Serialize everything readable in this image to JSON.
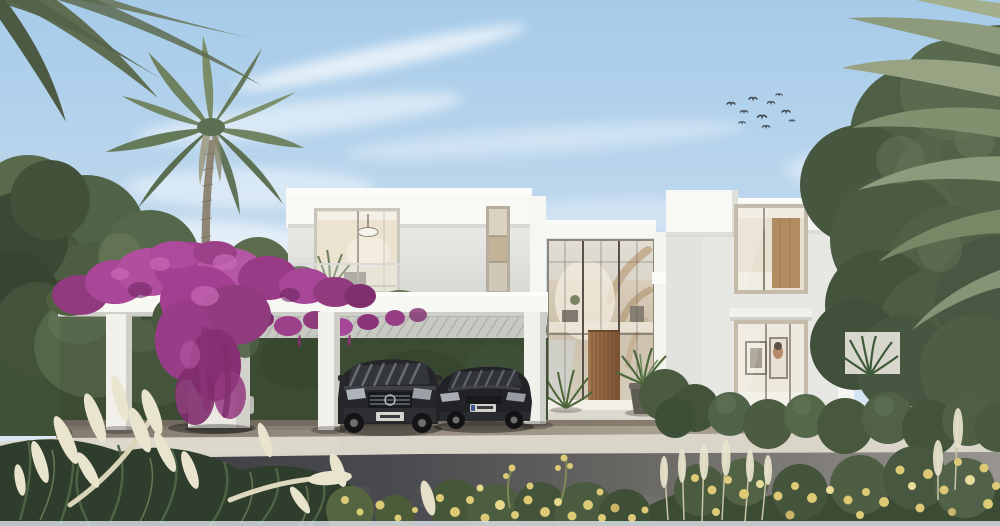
{
  "scene": {
    "type": "architectural-exterior-rendering",
    "description": "Photorealistic rendering of a modern two-storey white luxury villa with a double-height glass entrance atrium and wooden pivot door, a white pergola carport draped in magenta bougainvillea sheltering a dark SUV, a dark sedan and a white golf cart, flanked by palm trees, clipped hedges, a leafy tree, ornamental grasses and yellow flowers along a paved driveway under a clear blue sky with a small flock of birds",
    "time_of_day": "day",
    "weather": "sunny",
    "objects": [
      "sky",
      "clouds",
      "bird-flock",
      "left-palm-tree",
      "corner-palm-fronds",
      "right-palm-fronds",
      "background-trees",
      "right-tree",
      "villa-left-wing",
      "entrance-atrium",
      "wood-pivot-door",
      "villa-right-wing",
      "pergola-carport",
      "bougainvillea",
      "hedge",
      "golf-cart",
      "suv",
      "sedan",
      "planter-column",
      "entry-potted-plants",
      "entrance-steps",
      "driveway",
      "curb",
      "road",
      "ornamental-grass-plumes",
      "yellow-flowers",
      "shrubs",
      "neighbor-structures"
    ]
  },
  "counts": {
    "birds": 10,
    "cars": 2,
    "pergola_posts": 3,
    "storeys": 2
  },
  "colors": {
    "sky_top": "#a6cbe9",
    "sky_horizon": "#e6eff5",
    "cloud_white": "#ffffff",
    "bird_dark": "#41464d",
    "villa_white": "#f8f8f4",
    "villa_wall": "#e7e8e4",
    "villa_shadow_wall": "#b3afa6",
    "glass_warm": "#e4d9c7",
    "glass_cool": "#cfdade",
    "door_wood": "#a3764f",
    "accent_wood": "#b39872",
    "bougainvillea": "#a84697",
    "bougainvillea_dark": "#7f2e6e",
    "bougainvillea_light": "#c969b6",
    "palm_green": "#7a8c68",
    "palm_sage": "#8d9a7b",
    "tree_green": "#52624a",
    "hedge_green": "#3f5136",
    "shrub_green": "#4a5b40",
    "grass_plume": "#e9e4cd",
    "flower_yellow": "#dcca77",
    "carport_beam": "#f7f7f3",
    "paving_light": "#d9d5c9",
    "road_dark": "#37383c",
    "road_light": "#989590",
    "carport_ground": "#968d7f",
    "car_dark": "#26262a",
    "golf_cart_body": "#d9d8d2",
    "golf_cart_seat": "#6d3136"
  }
}
